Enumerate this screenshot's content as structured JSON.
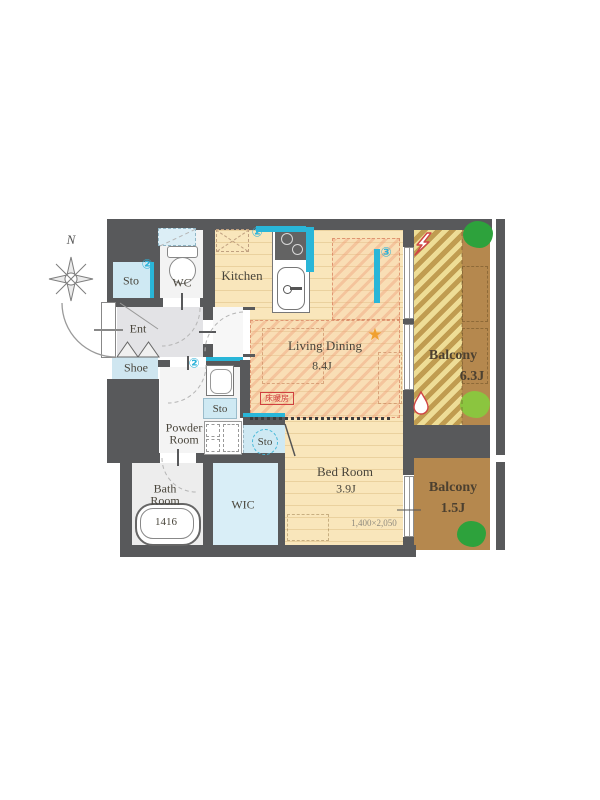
{
  "compass": {
    "north_label": "N"
  },
  "rooms": {
    "sto_entry": {
      "label": "Sto",
      "marker": "②"
    },
    "wc": {
      "label": "WC"
    },
    "kitchen": {
      "label": "Kitchen",
      "marker": "②"
    },
    "living_dining": {
      "label": "Living Dining",
      "size": "8.4J",
      "marker": "③",
      "floor_heating_label": "床暖房"
    },
    "entrance": {
      "label": "Ent"
    },
    "shoe": {
      "label": "Shoe"
    },
    "powder_room": {
      "line1": "Powder",
      "line2": "Room",
      "marker": "②"
    },
    "sto_hall": {
      "label": "Sto"
    },
    "sto_closet": {
      "label": "Sto"
    },
    "bath_room": {
      "line1": "Bath",
      "line2": "Room",
      "tub_size": "1416"
    },
    "wic": {
      "label": "WIC"
    },
    "bed_room": {
      "label": "Bed Room",
      "size": "3.9J",
      "window_dimension": "1,400×2,050"
    },
    "balcony_main": {
      "label": "Balcony",
      "size": "6.3J"
    },
    "balcony_sub": {
      "label": "Balcony",
      "size": "1.5J"
    }
  },
  "icons": {
    "star": "★"
  },
  "colors": {
    "wall": "#58595b",
    "accent_cyan": "#29b6d8",
    "wood_floor": "#f9e6bb",
    "hatch_stripe": "#ec946e",
    "balcony_brown": "#b5884e",
    "balcony_hatch_light": "#eedd96",
    "tree_green": "#2da23c",
    "tree_light_green": "#8bc53f",
    "alert_red": "#d04545",
    "light_blue_storage": "#cfe9f3"
  }
}
